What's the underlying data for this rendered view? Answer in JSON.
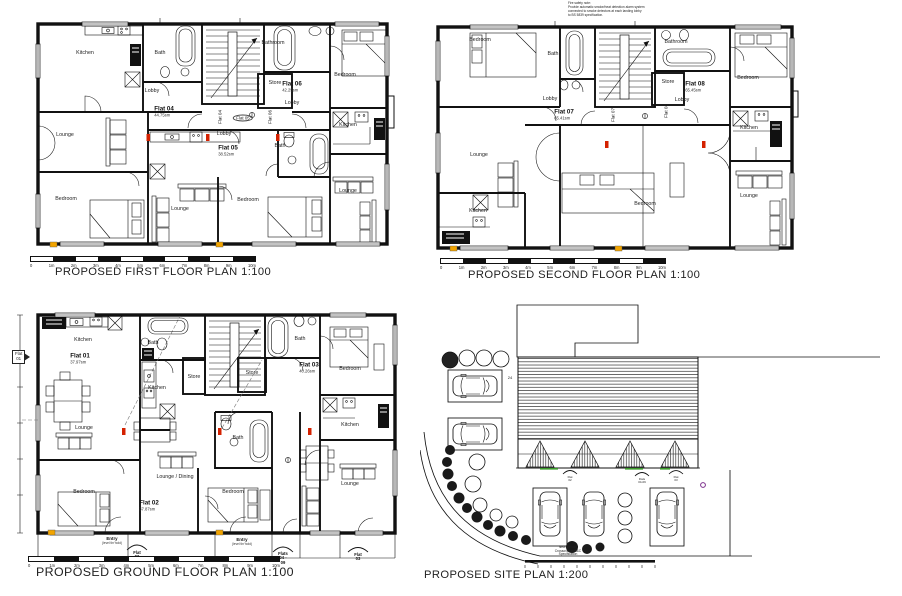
{
  "titles": {
    "first": "PROPOSED FIRST FLOOR PLAN 1:100",
    "second": "PROPOSED SECOND FLOOR PLAN 1:100",
    "ground": "PROPOSED GROUND FLOOR PLAN 1:100",
    "site": "PROPOSED SITE PLAN 1:200"
  },
  "scale": [
    "0",
    "1m",
    "2m",
    "3m",
    "4m",
    "5m",
    "6m",
    "7m",
    "8m",
    "9m",
    "10m"
  ],
  "first": {
    "rooms": {
      "kitchen_tl": "Kitchen",
      "bath_top": "Bath",
      "bathroom": "Bathroom",
      "bedroom_tr": "Bedroom",
      "store": "Store",
      "lobby_f06": "Lobby",
      "lobby_f04": "Lobby",
      "lobby_f05": "Lobby",
      "bath_mid": "Bath",
      "kitchen_r": "Kitchen",
      "lounge_l": "Lounge",
      "bedroom_bl": "Bedroom",
      "lounge_bc": "Lounge",
      "bedroom_bc": "Bedroom",
      "lounge_br": "Lounge"
    },
    "flats": {
      "f04": {
        "name": "Flat 04",
        "area": "44.75sm"
      },
      "f05": {
        "name": "Flat 05",
        "area": "38.52sm"
      },
      "f06": {
        "name": "Flat 06",
        "area": "42.25sm"
      }
    },
    "tags": {
      "f04": "Flat 04",
      "f05": "Flat 05",
      "f06": "Flat 06"
    }
  },
  "second": {
    "rooms": {
      "bedroom_tl": "Bedroom",
      "bath_top": "Bath",
      "bathroom": "Bathroom",
      "bedroom_tr": "Bedroom",
      "store": "Store",
      "lobby_l": "Lobby",
      "lobby_r": "Lobby",
      "lounge_l": "Lounge",
      "kitchen_l": "Kitchen",
      "bedroom_b": "Bedroom",
      "kitchen_r": "Kitchen",
      "lounge_r": "Lounge"
    },
    "flats": {
      "f07": {
        "name": "Flat 07",
        "area": "65.41sm"
      },
      "f08": {
        "name": "Flat 08",
        "area": "65.45sm"
      }
    },
    "tags": {
      "f07": "Flat 07",
      "f08": "Flat 08"
    },
    "notes": "Fire safety note:\nProvide automatic smoke/heat detection alarm system\nconnected to smoke detectors at each landing lobby\nto BS 5839 specification."
  },
  "ground": {
    "rooms": {
      "kitchen_tl": "Kitchen",
      "bath_tl": "Bath",
      "kitchen_c": "Kitchen",
      "store_l": "Store",
      "store_r": "Store",
      "bath_tr": "Bath",
      "bedroom_tr": "Bedroom",
      "kitchen_r": "Kitchen",
      "lounge_l": "Lounge",
      "lounge_dining": "Lounge / Dining",
      "bath_c": "Bath",
      "bedroom_bl": "Bedroom",
      "bedroom_bc": "Bedroom",
      "lounge_br": "Lounge"
    },
    "flats": {
      "f01": {
        "name": "Flat 01",
        "area": "37.97sm"
      },
      "f02": {
        "name": "Flat 02",
        "area": "37.87sm"
      },
      "f03": {
        "name": "Flat 03",
        "area": "40.26sm"
      }
    },
    "tag_flat01": "Flat\n01",
    "entries": {
      "entry1": "Entry",
      "entry1_sub": "(level thr'hold)",
      "entry2": "Entry",
      "entry2_sub": "(level thr'hold)",
      "canopy_f02": "Flat\n02",
      "canopy_f0409": "Flats\n04 -\n09",
      "canopy_f03": "Flat\n03"
    }
  },
  "site": {
    "note": "New Vehicle\nCrossover to S&C\nSpecification",
    "marks": {
      "c1": "Flat\n02",
      "c2": "Flats\n04-09",
      "c3": "Flat\n03",
      "num": "24"
    }
  }
}
